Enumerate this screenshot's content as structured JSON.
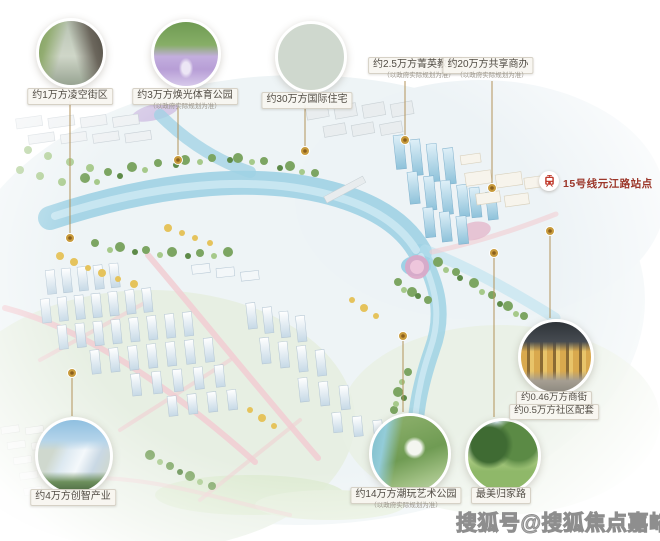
{
  "page": {
    "background": "#ffffff"
  },
  "colors": {
    "leader_line_gold": "#b3935a",
    "anchor_dot_gold": "#c89b3c",
    "label_text": "#514c44",
    "note_gray": "#9b968c",
    "metro_red": "#9c372a",
    "watermark_gray": "#8e8e8e",
    "water_blue": "#9fd2e4",
    "road_pink": "#f1cdd2"
  },
  "callouts": {
    "street_block": {
      "label": "约1万方凌空街区"
    },
    "sports_park": {
      "label": "约3万方焕光体育公园",
      "note": "（以政府实际规划为准）"
    },
    "residence": {
      "label": "约30万方国际住宅"
    },
    "education": {
      "label": "约2.5万方菁英教育",
      "note": "（以政府实际规划为准）"
    },
    "business": {
      "label": "约20万方共享商办",
      "note": "（以政府实际规划为准）"
    },
    "retail": {
      "line1": "约0.46万方商街",
      "line2": "约0.5万方社区配套"
    },
    "homecoming": {
      "label": "最美归家路"
    },
    "art_park": {
      "label": "约14万方潮玩艺术公园",
      "note": "（以政府实际规划为准）"
    },
    "industry": {
      "label": "约4万方创智产业"
    }
  },
  "metro": {
    "label": "15号线元江路站点",
    "icon": "metro-train-icon"
  },
  "watermark": {
    "text": "搜狐号@搜狐焦点嘉峪关站"
  }
}
